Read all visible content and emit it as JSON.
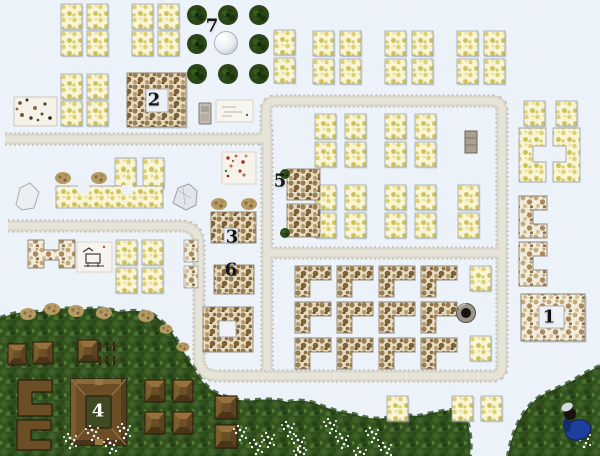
{
  "map": {
    "width_px": 600,
    "height_px": 456
  },
  "markers": [
    {
      "label": "1",
      "x": 549,
      "y": 317,
      "color": "#141414"
    },
    {
      "label": "2",
      "x": 154,
      "y": 100,
      "color": "#141414"
    },
    {
      "label": "3",
      "x": 232,
      "y": 237,
      "color": "#141414"
    },
    {
      "label": "4",
      "x": 98,
      "y": 411,
      "color": "#ffffff"
    },
    {
      "label": "5",
      "x": 280,
      "y": 181,
      "color": "#141414"
    },
    {
      "label": "6",
      "x": 231,
      "y": 270,
      "color": "#141414"
    },
    {
      "label": "7",
      "x": 212,
      "y": 26,
      "color": "#141414"
    }
  ],
  "palette": {
    "snow": "#eef3f9",
    "snow_shade": "#dfe8f3",
    "road": "#d7d3c6",
    "road_edge": "#b7b2a2",
    "tile": "#f8f4d6",
    "tile_blob": "#decf6e",
    "grass": "#33521f",
    "grass_dark": "#274215",
    "tree": "#2a4517",
    "wood": "#6b4e26",
    "wood_dark": "#2a1f0e",
    "mottle_tan": "#a9895b",
    "accent_blue": "#1e3f9c",
    "label_dark": "#141414",
    "label_light": "#ffffff"
  },
  "icons": [
    {
      "name": "pine-tree-icon"
    },
    {
      "name": "fountain-orb-icon"
    },
    {
      "name": "well-icon"
    },
    {
      "name": "boulder-icon"
    },
    {
      "name": "white-rock-icon"
    },
    {
      "name": "statue-icon"
    },
    {
      "name": "crate-icon"
    },
    {
      "name": "hut-icon"
    },
    {
      "name": "fence-icon"
    },
    {
      "name": "flower-cluster-icon"
    },
    {
      "name": "npc-figure-icon"
    },
    {
      "name": "bush-icon"
    }
  ]
}
